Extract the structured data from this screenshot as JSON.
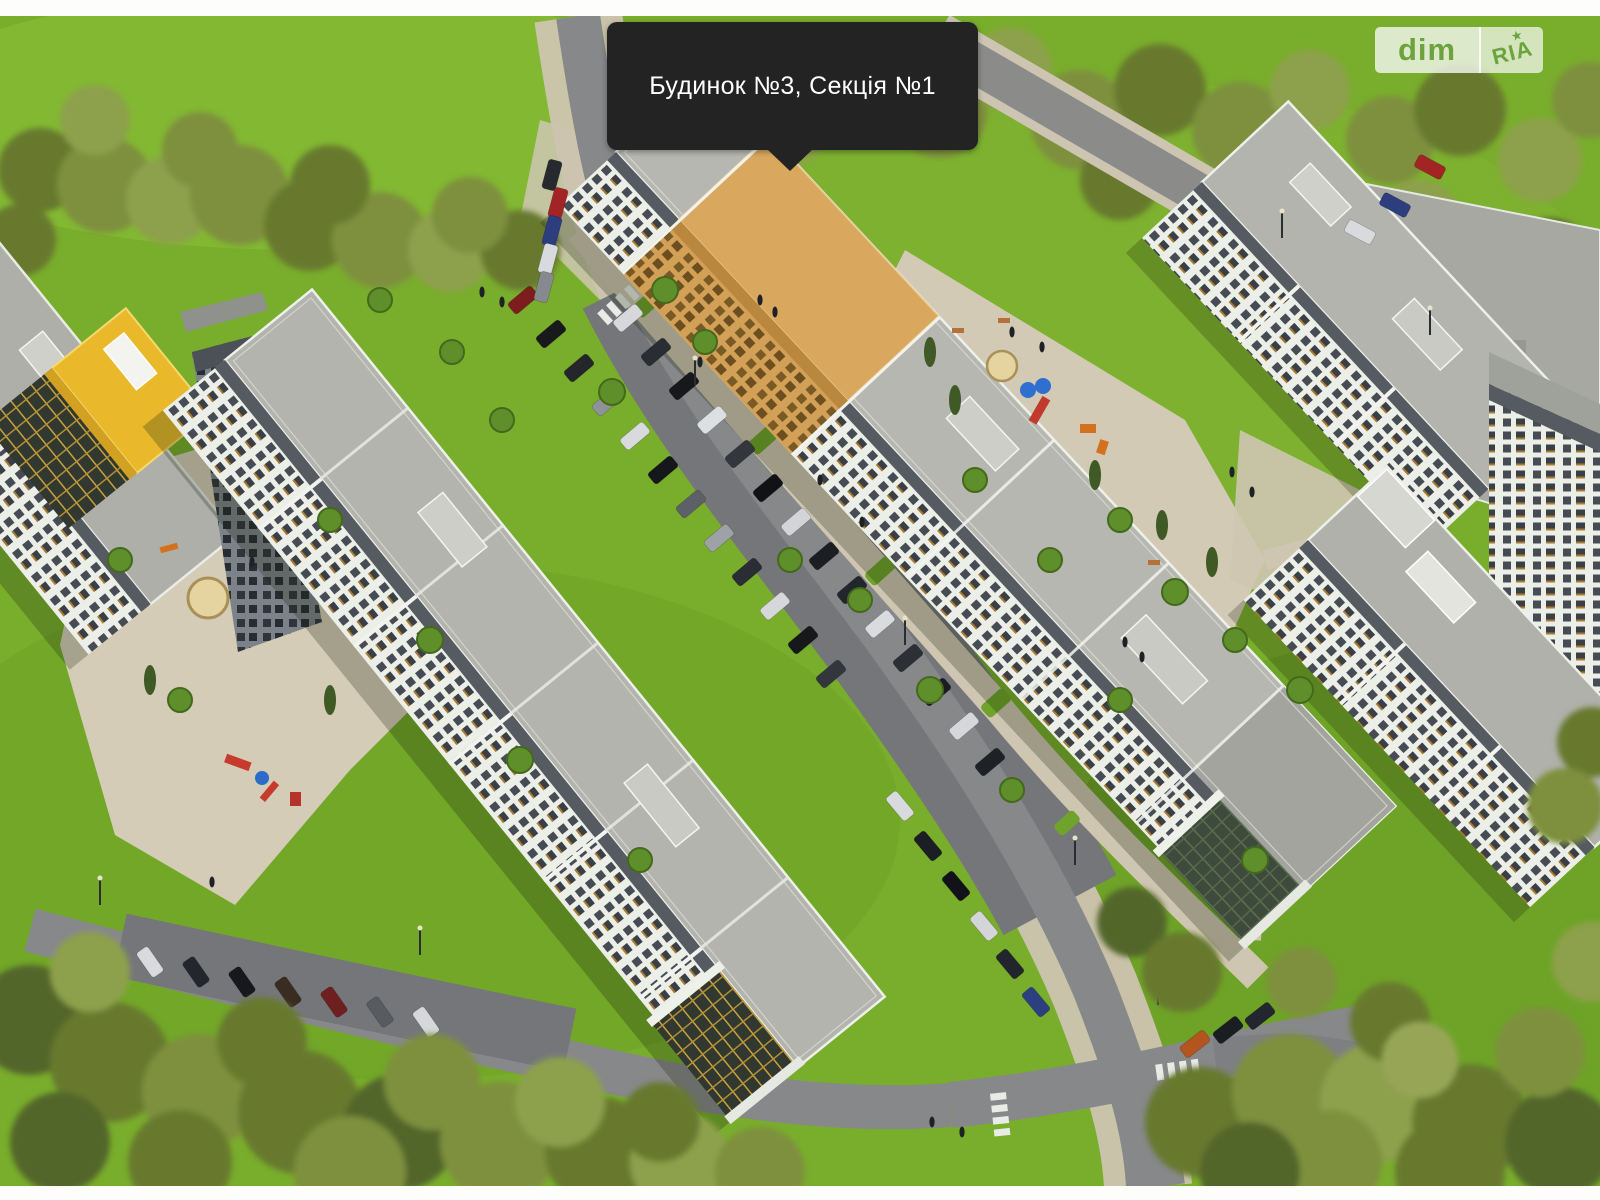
{
  "tooltip": {
    "text": "Будинок №3, Секція №1"
  },
  "watermark": {
    "dim": "dim",
    "ria": "RIA"
  },
  "theme": {
    "tooltip_bg": "#232323",
    "tooltip_text": "#ffffff",
    "logo_green": "#6da33c",
    "highlight_orange": "#d9a85e",
    "highlight_facade": "#c99a52"
  }
}
